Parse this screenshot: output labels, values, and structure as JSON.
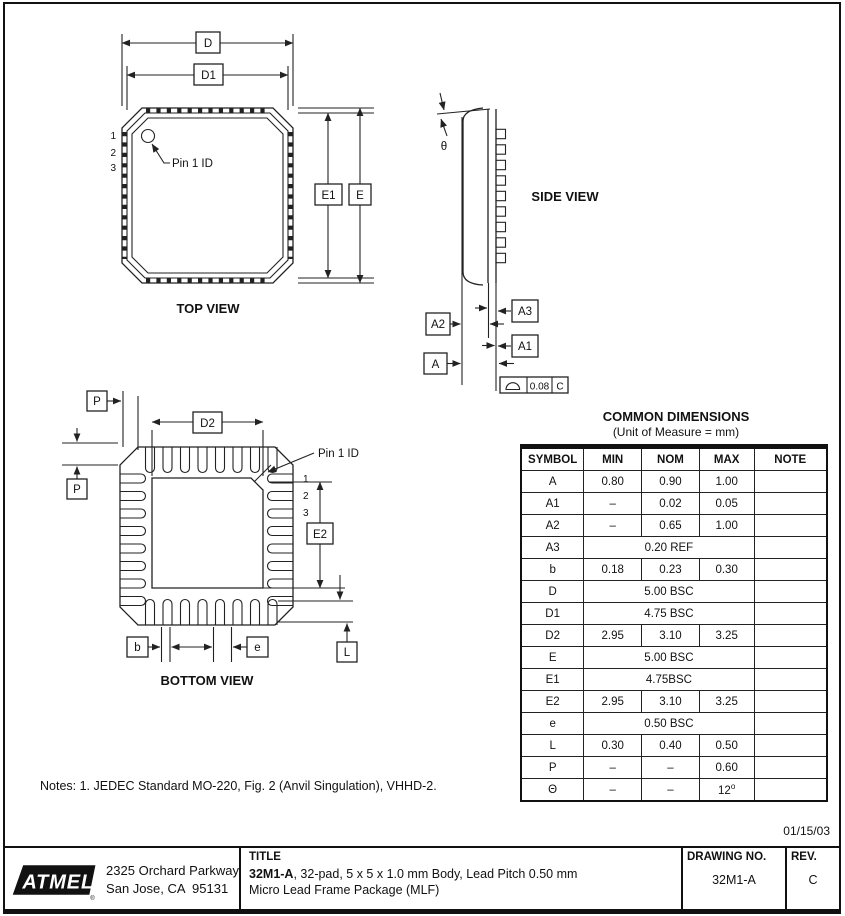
{
  "drawing": {
    "date": "01/15/03",
    "notes": "Notes: 1. JEDEC Standard MO-220, Fig. 2 (Anvil Singulation), VHHD-2.",
    "top_view": {
      "caption": "TOP VIEW",
      "dim_d": "D",
      "dim_d1": "D1",
      "dim_e": "E",
      "dim_e1": "E1",
      "pin1_label": "Pin 1 ID",
      "pin_numbers": [
        "1",
        "2",
        "3"
      ]
    },
    "side_view": {
      "caption": "SIDE VIEW",
      "dim_theta": "θ",
      "dim_a": "A",
      "dim_a1": "A1",
      "dim_a2": "A2",
      "dim_a3": "A3",
      "fcf_tolerance": "0.08",
      "fcf_datum": "C"
    },
    "bottom_view": {
      "caption": "BOTTOM VIEW",
      "dim_p_top": "P",
      "dim_p_left": "P",
      "dim_d2": "D2",
      "dim_e2": "E2",
      "dim_b": "b",
      "dim_e_pitch": "e",
      "dim_l": "L",
      "pin1_label": "Pin 1 ID",
      "pin_numbers": [
        "1",
        "2",
        "3"
      ]
    }
  },
  "table": {
    "title": "COMMON DIMENSIONS",
    "subtitle": "(Unit of Measure = mm)",
    "headers": [
      "SYMBOL",
      "MIN",
      "NOM",
      "MAX",
      "NOTE"
    ],
    "rows": [
      {
        "symbol": "A",
        "min": "0.80",
        "nom": "0.90",
        "max": "1.00",
        "note": ""
      },
      {
        "symbol": "A1",
        "min": "–",
        "nom": "0.02",
        "max": "0.05",
        "note": ""
      },
      {
        "symbol": "A2",
        "min": "–",
        "nom": "0.65",
        "max": "1.00",
        "note": ""
      },
      {
        "symbol": "A3",
        "value": "0.20 REF",
        "note": ""
      },
      {
        "symbol": "b",
        "min": "0.18",
        "nom": "0.23",
        "max": "0.30",
        "note": ""
      },
      {
        "symbol": "D",
        "value": "5.00 BSC",
        "note": ""
      },
      {
        "symbol": "D1",
        "value": "4.75 BSC",
        "note": ""
      },
      {
        "symbol": "D2",
        "min": "2.95",
        "nom": "3.10",
        "max": "3.25",
        "note": ""
      },
      {
        "symbol": "E",
        "value": "5.00 BSC",
        "note": ""
      },
      {
        "symbol": "E1",
        "value": "4.75BSC",
        "note": ""
      },
      {
        "symbol": "E2",
        "min": "2.95",
        "nom": "3.10",
        "max": "3.25",
        "note": ""
      },
      {
        "symbol": "e",
        "value": "0.50 BSC",
        "note": ""
      },
      {
        "symbol": "L",
        "min": "0.30",
        "nom": "0.40",
        "max": "0.50",
        "note": ""
      },
      {
        "symbol": "P",
        "min": "–",
        "nom": "–",
        "max": "0.60",
        "note": ""
      },
      {
        "symbol": "Θ",
        "min": "–",
        "nom": "–",
        "max": "12",
        "max_sup": "o",
        "note": ""
      }
    ]
  },
  "title_block": {
    "logo_text": "ATMEL",
    "address_line1": "2325 Orchard Parkway",
    "address_line2": "San Jose, CA  95131",
    "title_label": "TITLE",
    "title_bold": "32M1-A",
    "title_rest": ", 32-pad, 5 x 5 x 1.0 mm Body, Lead Pitch 0.50 mm",
    "title_line2": "Micro Lead Frame Package (MLF)",
    "drawing_no_label": "DRAWING NO.",
    "drawing_no": "32M1-A",
    "rev_label": "REV.",
    "rev": "C"
  }
}
